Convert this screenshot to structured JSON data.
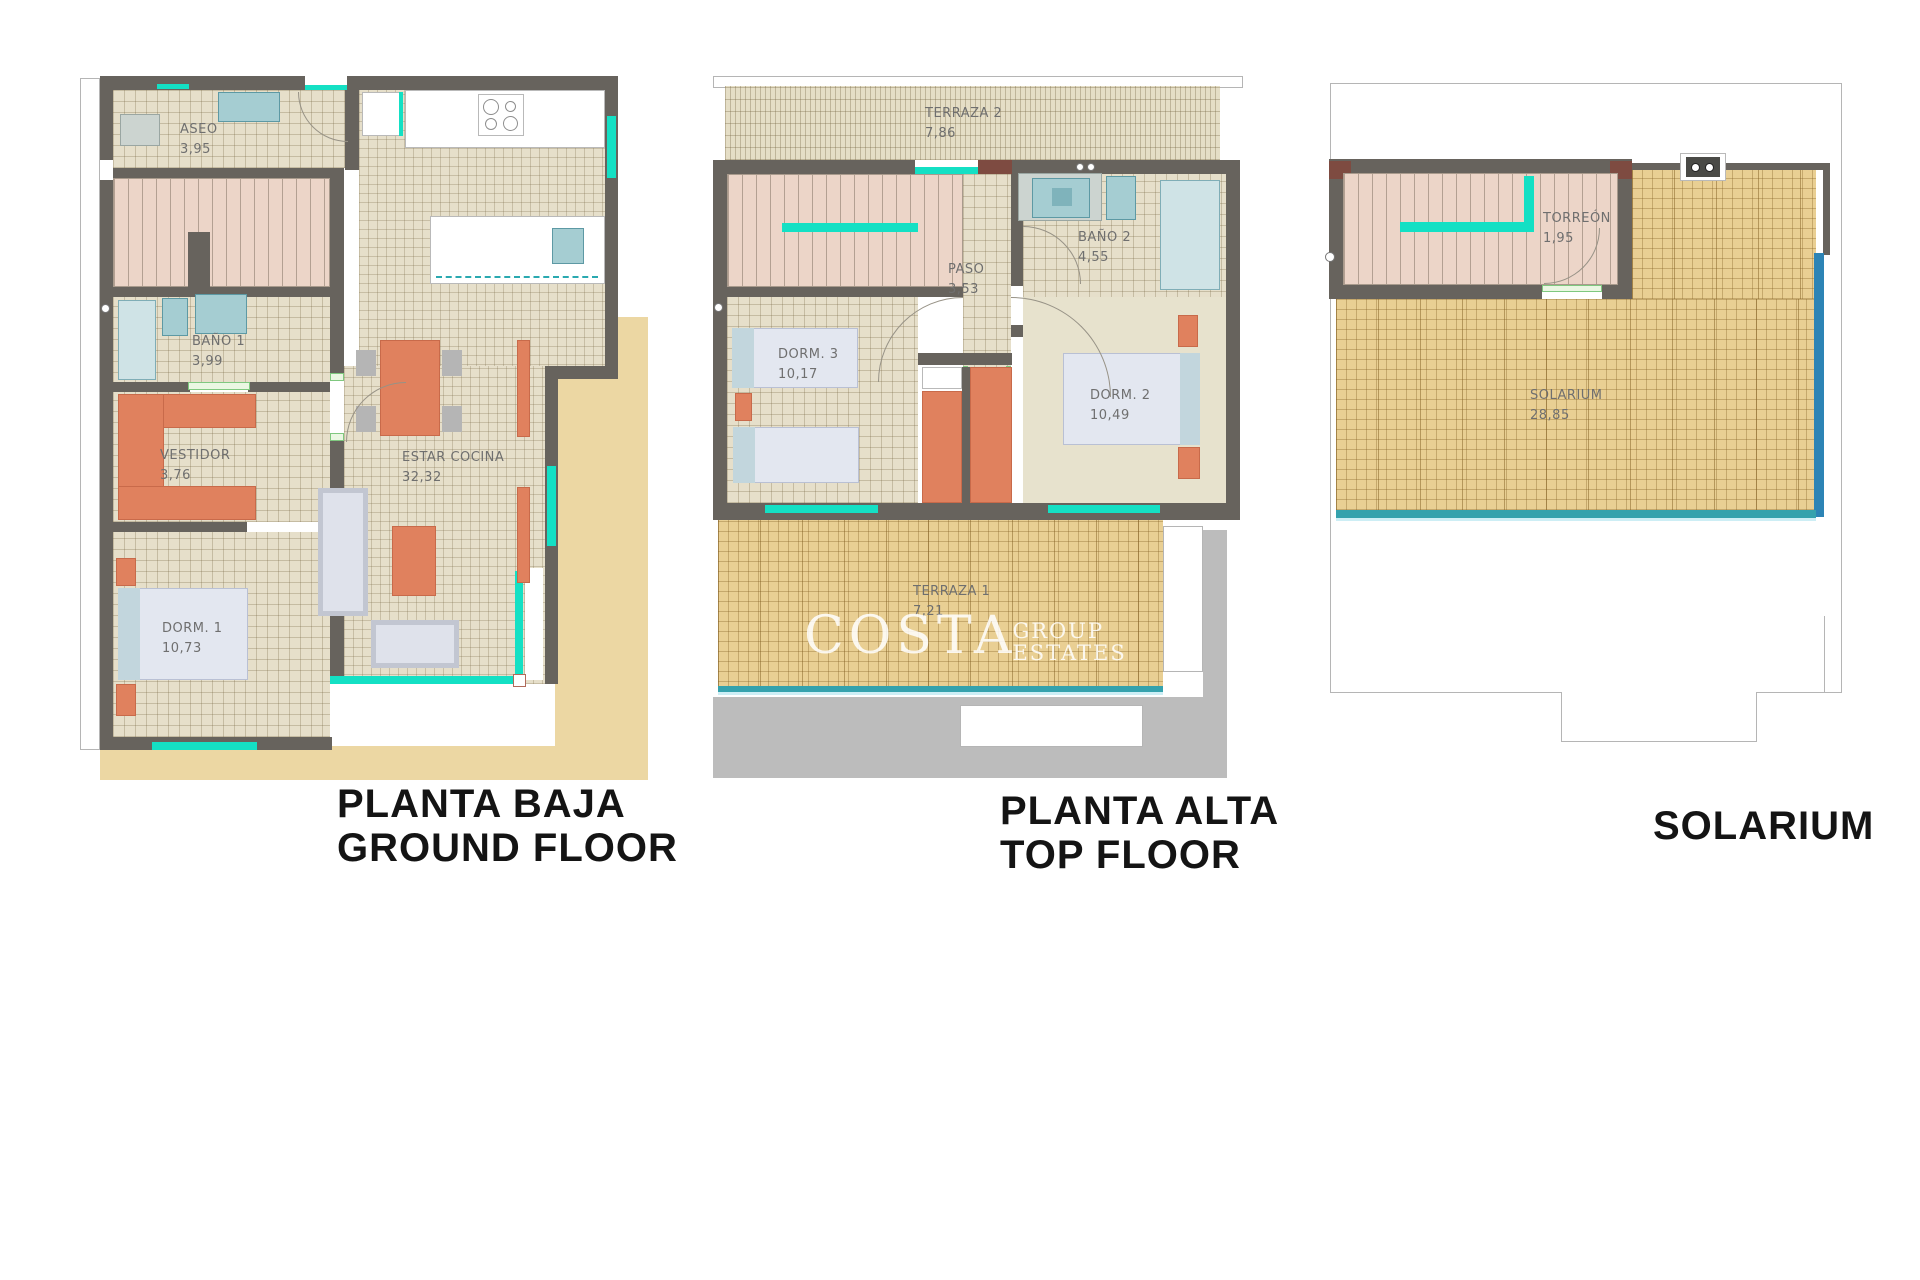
{
  "palette": {
    "wall": "#67635d",
    "window_cyan": "#14e0c4",
    "terrace_tan": "#e9cf93",
    "outdoor_sand": "#ecd7a3",
    "stairs_pink": "#ecd5c8",
    "furniture_orange": "#e0815e",
    "fixture_teal": "#a5cdd2",
    "glass_rail_blue": "#2d84b5",
    "shadow_gray": "#bcbcbc",
    "floor_beige": "#e6dfca"
  },
  "plans": [
    {
      "id": "planta-baja",
      "caption_line1": "PLANTA BAJA",
      "caption_line2": "GROUND FLOOR",
      "rooms": [
        {
          "name": "ASEO",
          "area": "3,95"
        },
        {
          "name": "BAÑO 1",
          "area": "3,99"
        },
        {
          "name": "VESTIDOR",
          "area": "3,76"
        },
        {
          "name": "DORM. 1",
          "area": "10,73"
        },
        {
          "name": "ESTAR COCINA",
          "area": "32,32"
        }
      ]
    },
    {
      "id": "planta-alta",
      "caption_line1": "PLANTA ALTA",
      "caption_line2": "TOP FLOOR",
      "rooms": [
        {
          "name": "TERRAZA 2",
          "area": "7,86"
        },
        {
          "name": "PASO",
          "area": "3,53"
        },
        {
          "name": "BAÑO 2",
          "area": "4,55"
        },
        {
          "name": "DORM. 3",
          "area": "10,17"
        },
        {
          "name": "DORM. 2",
          "area": "10,49"
        },
        {
          "name": "TERRAZA 1",
          "area": "7,21"
        }
      ],
      "watermark": {
        "main": "COSTA",
        "sub_line1": "GROUP",
        "sub_line2": "ESTATES"
      }
    },
    {
      "id": "solarium",
      "caption_line1": "SOLARIUM",
      "caption_line2": "",
      "rooms": [
        {
          "name": "TORREÓN",
          "area": "1,95"
        },
        {
          "name": "SOLARIUM",
          "area": "28,85"
        }
      ]
    }
  ]
}
